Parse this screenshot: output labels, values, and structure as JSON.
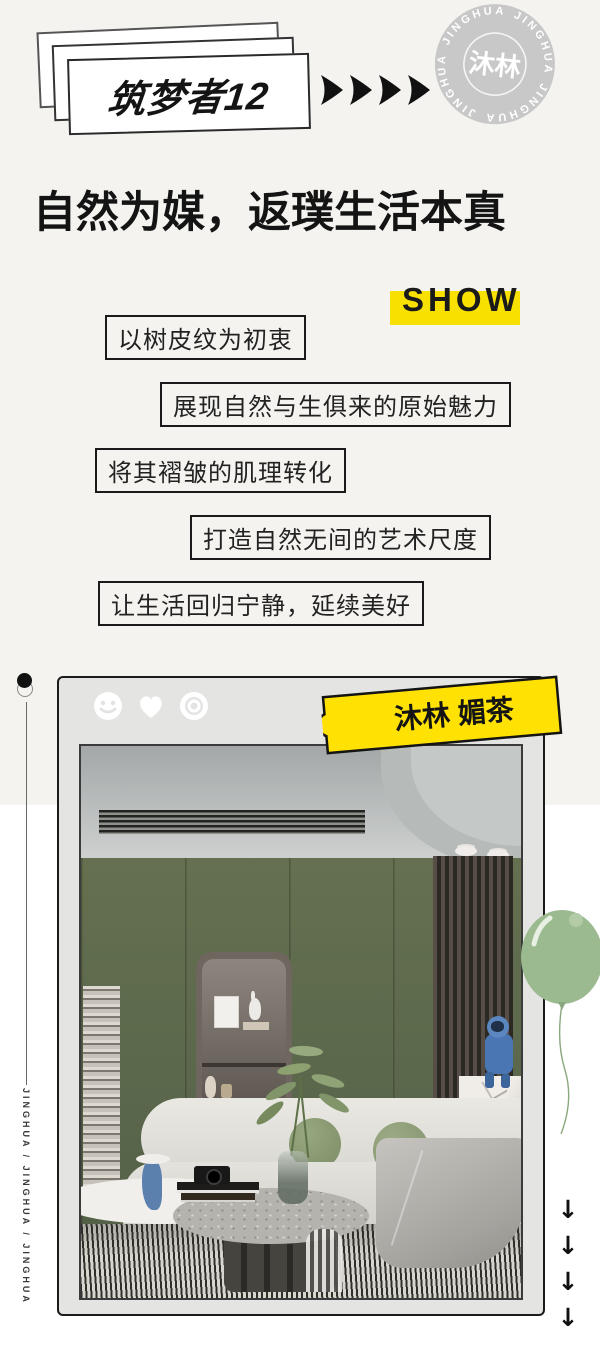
{
  "card": {
    "title": "筑梦者12"
  },
  "stamp": {
    "rim_word": "JINGHUA",
    "center": "沐林"
  },
  "headline": "自然为媒，返璞生活本真",
  "show_label": "SHOW",
  "quotes": [
    "以树皮纹为初衷",
    "展现自然与生俱来的原始魅力",
    "将其褶皱的肌理转化",
    "打造自然无间的艺术尺度",
    "让生活回归宁静，延续美好"
  ],
  "frame": {
    "tag_label": "沐林 媚茶",
    "reaction_icons": [
      "smiley-icon",
      "heart-icon",
      "target-icon"
    ]
  },
  "side_rail": {
    "vertical_text": "JINGHUA / JINGHUA / JINGHUA"
  },
  "down_arrows": {
    "glyph": "↓",
    "count": 4
  },
  "icons": {
    "header_arrow": "right-arrow-icon",
    "pin": "pin-dot-icon",
    "balloon": "balloon-icon"
  },
  "colors": {
    "accent_yellow": "#f8e000",
    "balloon_green": "#9cba8f",
    "wall_olive": "#5e6a50",
    "stamp_gray": "#c8c8c8",
    "ink": "#141414",
    "page_top": "#f4f3ef",
    "page_bottom": "#ffffff"
  }
}
